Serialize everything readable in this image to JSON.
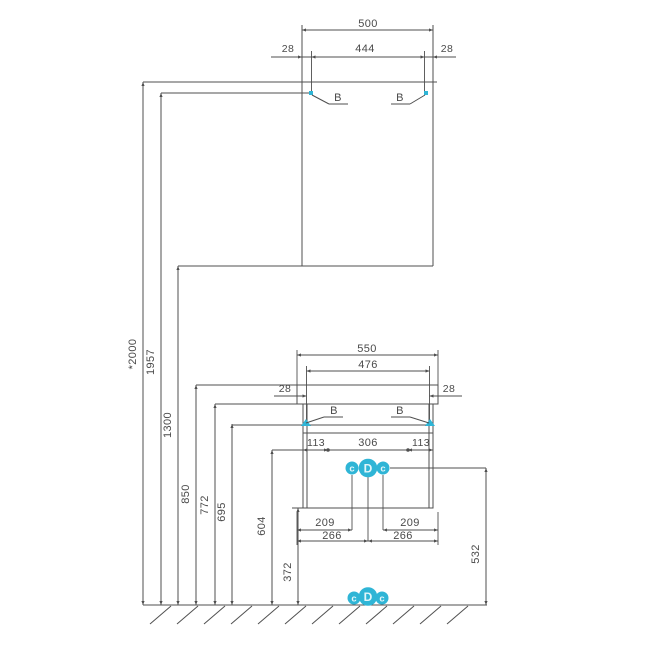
{
  "diagram": {
    "type": "installation-dimension-drawing",
    "colors": {
      "line": "#4f4f4f",
      "text": "#4a4a4a",
      "accent": "#2fb5d6",
      "marker_text": "#e3f6fa"
    },
    "mirror": {
      "width": "500",
      "bracket_span": "444",
      "left_margin": "28",
      "right_margin": "28",
      "bracket_left": "B",
      "bracket_right": "B"
    },
    "vanity": {
      "top_width": "550",
      "bracket_span": "476",
      "left_margin": "28",
      "right_margin": "28",
      "bracket_left": "B",
      "bracket_right": "B",
      "front": {
        "left": "113",
        "center": "306",
        "right": "113"
      },
      "drain_offset_left": "209",
      "drain_offset_right": "209",
      "center_offset_left": "266",
      "center_offset_right": "266"
    },
    "heights": {
      "total": "*2000",
      "mirror_brackets": "1957",
      "mirror_bottom": "1300",
      "sink_top": "850",
      "sink_bottom": "772",
      "vanity_brackets": "695",
      "front_points": "604",
      "connection_line": "532",
      "cabinet_bottom": "372"
    },
    "connections": {
      "left": "c",
      "center": "D",
      "right": "c"
    },
    "floor_connections": {
      "left": "c",
      "center": "D",
      "right": "c"
    }
  }
}
